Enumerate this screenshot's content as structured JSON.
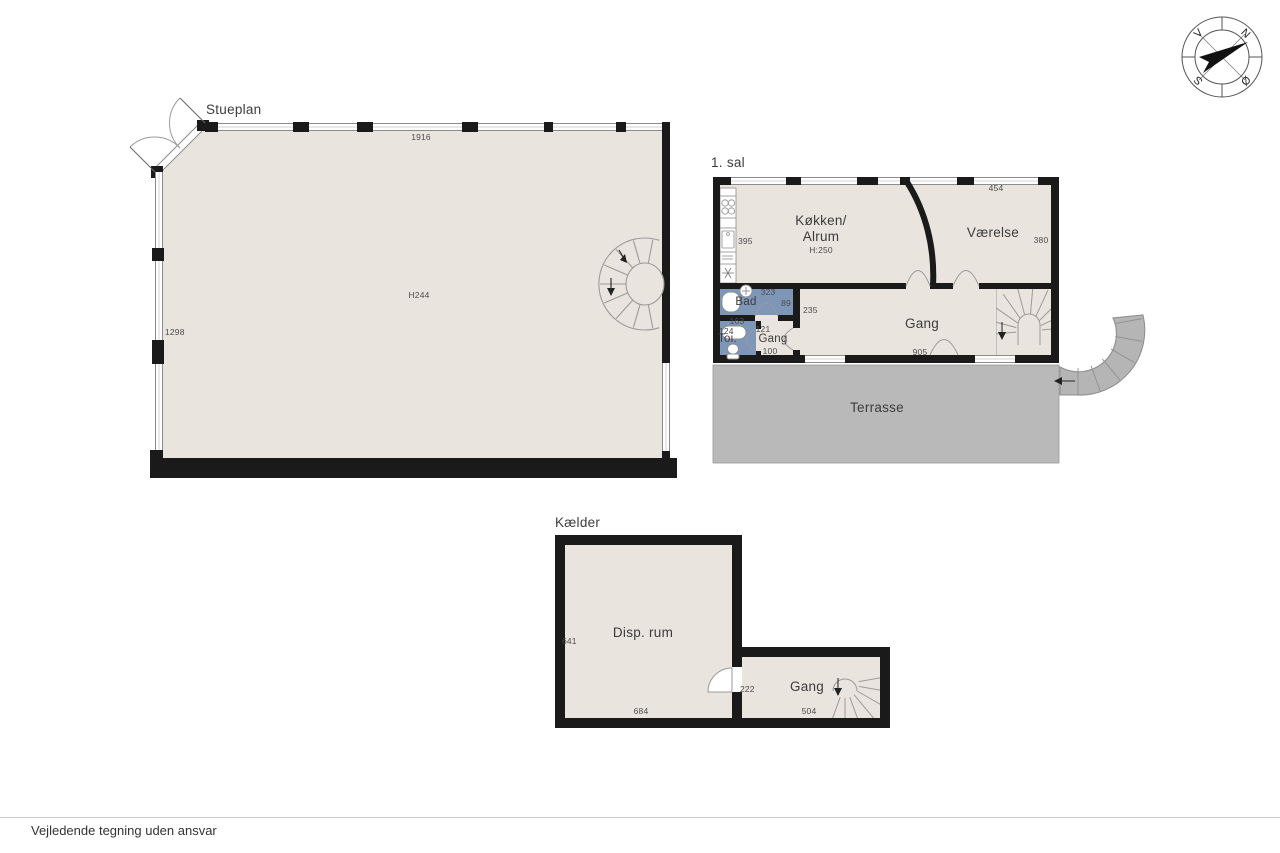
{
  "page": {
    "footer_note": "Vejledende tegning uden ansvar"
  },
  "compass": {
    "n": "N",
    "s": "S",
    "e": "Ø",
    "w": "V"
  },
  "stueplan": {
    "title": "Stueplan",
    "room_height": "H244",
    "dim_top": "1916",
    "dim_left": "1298"
  },
  "first_floor": {
    "title": "1. sal",
    "kitchen_label_1": "Køkken/",
    "kitchen_label_2": "Alrum",
    "kitchen_height": "H:250",
    "kitchen_dim_left": "395",
    "vaerelse_label": "Værelse",
    "vaerelse_dim_top": "454",
    "vaerelse_dim_right": "380",
    "bad_label": "Bad",
    "bad_dim_top": "323",
    "bad_dim_right": "89",
    "toi_label": "Toi.",
    "toi_dim_top": "163",
    "toi_dim_left": "124",
    "gang_small_label": "Gang",
    "gang_small_dim_top": "121",
    "gang_small_dim_bottom": "100",
    "gang_label": "Gang",
    "gang_dim_left": "235",
    "gang_dim_bottom": "905",
    "terrace_label": "Terrasse"
  },
  "basement": {
    "title": "Kælder",
    "disp_label": "Disp. rum",
    "disp_dim_left": "641",
    "disp_dim_bottom": "684",
    "gang_label": "Gang",
    "gang_dim_bottom": "504",
    "door_dim": "222"
  },
  "colors": {
    "floor": "#e9e4dd",
    "wet_room": "#7e96b7",
    "terrace": "#b9b9b9",
    "wall": "#1a1a1a"
  }
}
